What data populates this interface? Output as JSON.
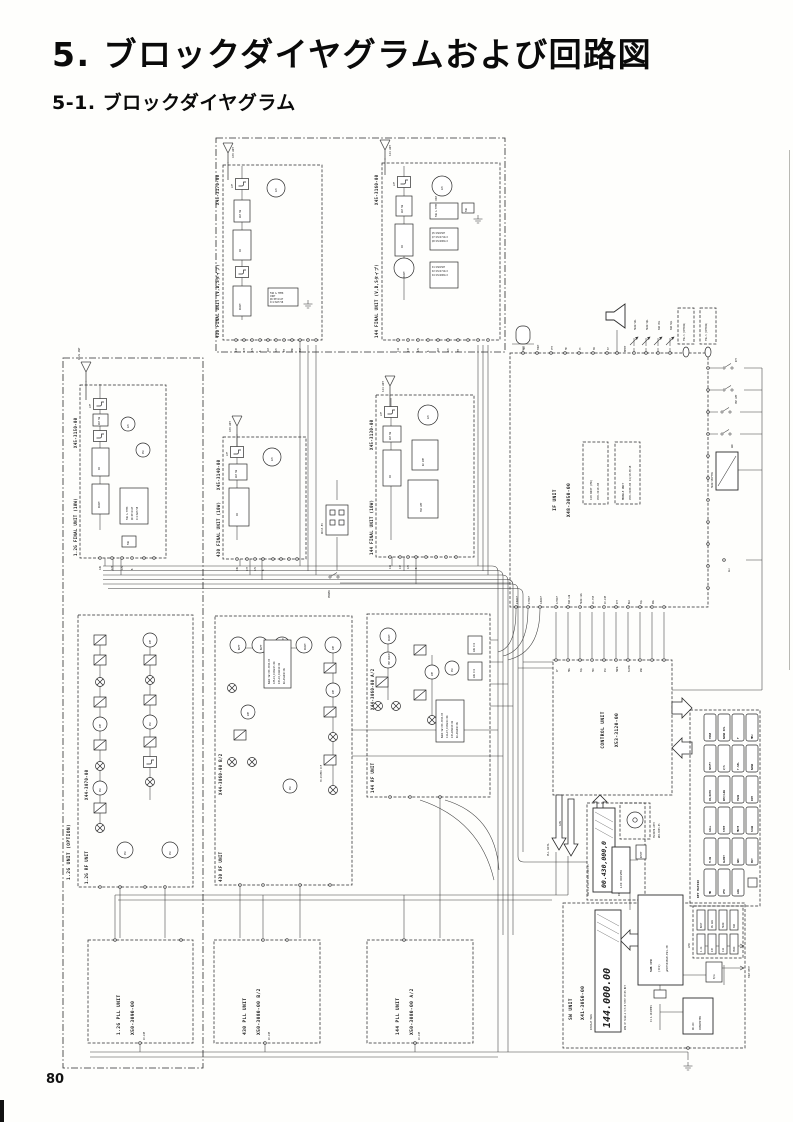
{
  "page": {
    "title": "5. ブロックダイヤグラムおよび回路図",
    "subtitle": "5-1. ブロックダイヤグラム",
    "page_number": "80"
  },
  "units": {
    "opt12g": "1.2G UNIT (OPTION)",
    "f12g": {
      "n": "1.2G FINAL UNIT (10W)",
      "c": "X45-3150-00"
    },
    "rf12g": {
      "n": "1.2G RF UNIT",
      "c": "X44-3070-00"
    },
    "f430": {
      "n": "430 FINAL UNIT (10W)",
      "c": "X45-3140-00"
    },
    "f144": {
      "n": "144 FINAL UNIT (10W)",
      "c": "X45-3130-00"
    },
    "f430vds": {
      "n": "430 FINAL UNIT (V,D,Sタイプ)",
      "c": "X45-3170-00"
    },
    "f144vds": {
      "n": "144 FINAL UNIT (V,D,Sタイプ)",
      "c": "X45-3160-00"
    },
    "rf430": {
      "n": "430 RF UNIT",
      "c": "X44-3060-00 B/2"
    },
    "rf144": {
      "n": "144 RF UNIT",
      "c": "X44-3060-00 A/2"
    },
    "pll12g": {
      "n": "1.2G PLL UNIT",
      "c": "X50-3090-00"
    },
    "pll430": {
      "n": "430 PLL UNIT",
      "c": "X50-3080-00 B/2"
    },
    "pll144": {
      "n": "144 PLL UNIT",
      "c": "X50-3080-00 A/2"
    },
    "ifu": {
      "n": "IF UNIT",
      "c": "X48-3050-00"
    },
    "c28": {
      "n": "C28 UNIT (MR)",
      "c": "X58-3410-00"
    },
    "module": {
      "n": "MODULE UNIT",
      "c": "X58-3180-00 14/18·M/18"
    },
    "control": {
      "n": "CONTROL UNIT",
      "c": "X53-3120-00"
    },
    "keymatrix": "KEY MATRIX",
    "sw": {
      "n": "SW UNIT",
      "c": "X41-3050-00"
    },
    "led": "LED",
    "sublcd": {
      "n": "SUB LCD ASSY B30-0905-05",
      "c": "DISPLAY SUB LCD"
    },
    "encoder": {
      "n": "ENCODER ASSY",
      "c": "W02-0605-05"
    }
  },
  "glossary": {
    "lpf": "LPF",
    "bpf": "BPF",
    "pa": "PA",
    "drive": "DRIVE",
    "ant_sw": "ANT SW",
    "fan": "FAN",
    "fan_temp": "FAN & TEMP. CONT",
    "osc": "OSC",
    "mix": "MIX",
    "amp": "AMP",
    "apc": "APC",
    "buff": "BUFF",
    "pre_drive": "PRE DRIVE",
    "rx_amp": "RX AMP",
    "trx_amp": "TRX AMP",
    "avr2": "AVR IC2",
    "avr1": "AVR IC1",
    "xcf": "76.455MHz XCF",
    "lcd_driver": "LCD DRIVER",
    "reset": "RESET",
    "cpu1": "SUB CPU",
    "cpu2": "(IC1)",
    "cpu3": "μPD75048GB-E91-3B",
    "xtal": "X1 4.19430MHz",
    "dcdc1": "DC-DC",
    "dcdc2": "CONVERTER",
    "ba": "B/A",
    "main_shifter": "MAIN SHIFTER",
    "display_main": "DISPLAY MAIN",
    "lcd_caption": "NEW CH SCAN A V/S B STEP CTCSS BIT",
    "main_lcd": "144.000.00",
    "sub_lcd": "00.430,000,0",
    "tsu": "TSU-5 (OPTION)"
  },
  "io": {
    "mic": "MIC",
    "tone": "TONE",
    "ptt": "PTT",
    "mic_vol": "MIC VOL",
    "power_cont": "POWER CONT",
    "pc": "PC",
    "sp": "SP",
    "beep": "BEEP",
    "main_vol": "MAIN VOL",
    "main_sql": "MAIN SQL",
    "sub_vol": "SUB VOL",
    "sub_sql": "SUB SQL",
    "power": "POWER",
    "dc_in": "DC13.8V",
    "key": "KEY",
    "alc": "ALC",
    "pll_data": "PLL DATA",
    "can": "CAN",
    "tone_beep": "TONE BEEP",
    "gnd": "GND",
    "m1024": "10.24M",
    "ant_12g": "1.2G ANT",
    "ant_430": "430 ANT",
    "ant_144": "144 ANT",
    "pre_amp": "PRE AMP",
    "abc": "ABC",
    "rb": "RB"
  },
  "terminals": {
    "if_bottom": [
      "43RXIF",
      "43TXIF",
      "12RXIF",
      "12TXIF",
      "SUB CAN",
      "MAIN CAN",
      "16.75M",
      "10.24M",
      "DET",
      "BLO",
      "SQL",
      "DBL"
    ],
    "ctrl_top": [
      "IF",
      "MOL",
      "SQL",
      "MIC",
      "DSC",
      "MAHR",
      "SAIHR",
      "NSK",
      "DRT",
      "CH"
    ],
    "if_top": [
      "MIC",
      "TONE",
      "PTT",
      "MV",
      "PC",
      "SB",
      "SP"
    ],
    "if_right": [
      "KEY",
      "PRE AMP",
      "PRE AMP",
      "ABC",
      "RB",
      "ALC",
      "RP",
      "SAF",
      "RAF",
      "CMX",
      "CTX"
    ],
    "f430b": [
      "43R",
      "43T",
      "12V",
      "B",
      "ANT",
      "APC",
      "8M",
      "PRD",
      "TGP"
    ],
    "f144b": [
      "144",
      "14T",
      "12V",
      "B",
      "ANT",
      "APC",
      "8M",
      "TGP"
    ],
    "f12b": [
      "12R",
      "12T",
      "12V",
      "B",
      "ANT",
      "APC"
    ],
    "vds430b": [
      "430",
      "43T",
      "12V",
      "B",
      "ANT",
      "APC",
      "8M",
      "PRD",
      "TGP",
      "FAN",
      "TH"
    ],
    "vds144b": [
      "144",
      "14T",
      "12V",
      "B",
      "ANT",
      "APC",
      "8M",
      "PRD",
      "TGP",
      "TH"
    ]
  },
  "notes": {
    "band_sw_430": [
      "BAND SW X50-3050-00",
      "12M→D1,D13&D15:ON",
      "430→D2,D4&D14:ON",
      "RX→D5&D16:ON",
      "(CN1)"
    ],
    "band_sw_144": [
      "BAND SW X50-3050-00",
      "144→D7,D13&D14:ON",
      "430→D8&D15:ON",
      "RX→D9&D16:ON",
      "(T)"
    ],
    "vds_parts_a": [
      "Q5:2SK1587",
      "Q7:2SC2712×2",
      "Q8:2SC4081×2"
    ],
    "vds_parts_b": [
      "D1:2SK1587",
      "D2:2SC2712×2",
      "D4:2SC4081×2"
    ],
    "fan_parts": [
      "FAN & TEMP.",
      "CONT",
      "Q6:DTC114Y",
      "IC1:BA7718"
    ]
  },
  "keys": [
    "TONE",
    "BAND SEL",
    "F",
    "MHz",
    "SHIFT",
    "V/S",
    "T.SEL",
    "BAND",
    "PA/AUTO",
    "REV/LOW",
    "TWIN",
    "DIM",
    "CALL",
    "STEP",
    "MUTE",
    "SCAN",
    "M.IN",
    "ALERT",
    "ABC",
    "ENT",
    "MR",
    "VFO",
    "LOW"
  ],
  "leds": [
    "BUSY",
    "ON AIR",
    "MAIN",
    "SUB",
    "1.2G",
    "430",
    "144",
    "PRIO"
  ]
}
